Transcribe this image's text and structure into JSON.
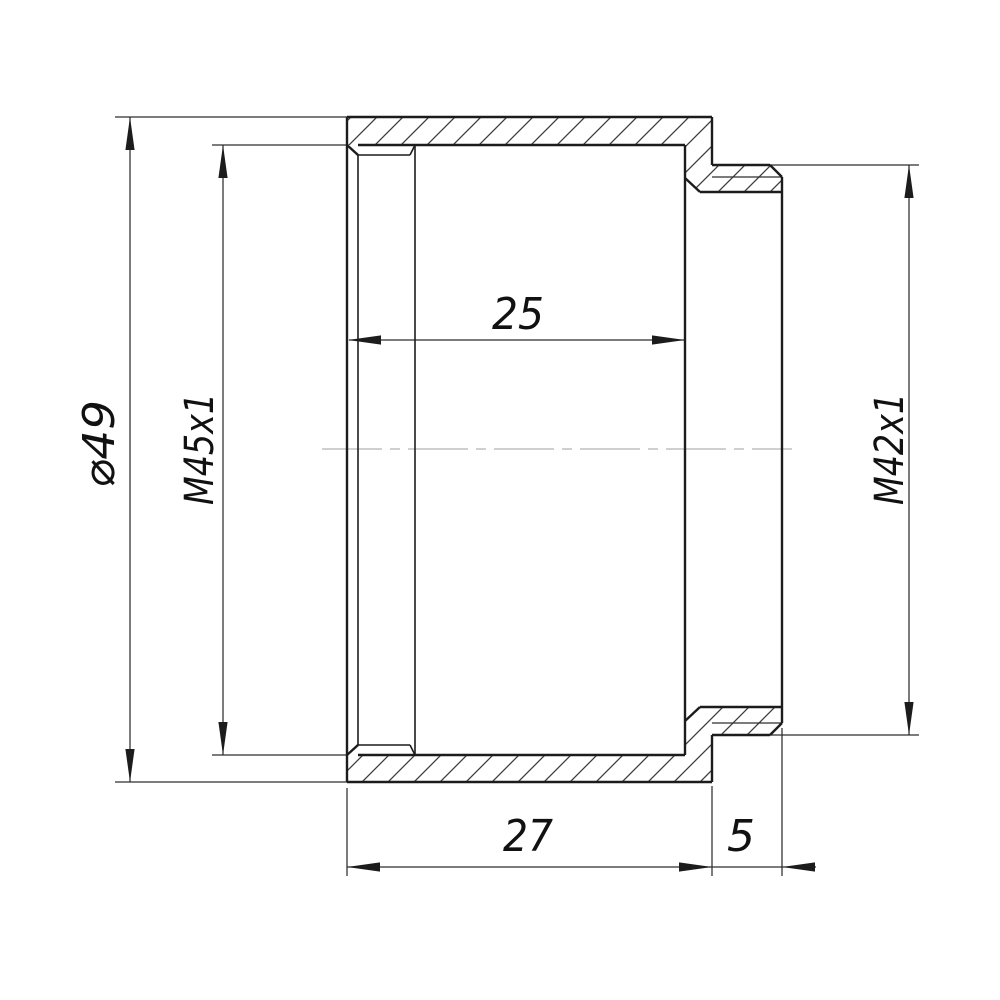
{
  "drawing": {
    "description": "cross-section drawing of a threaded step adapter ring",
    "dimension_values": {
      "outer_diameter": "⌀49",
      "left_internal_thread": "M45x1",
      "bore_depth": "25",
      "right_external_thread": "M42x1",
      "body_length": "27",
      "barrel_length": "5"
    },
    "colors": {
      "background": "#ffffff",
      "outline": "#1c1c1c",
      "thin_line": "#2e2e2e",
      "hatch": "#3c3c3c",
      "centerline": "#b3b3b3",
      "text": "#111111"
    },
    "labels": [
      {
        "id": "dim-label-outer-diameter",
        "text": "⌀49",
        "x": 114,
        "y": 444,
        "rotate": -90,
        "size": 44,
        "length": 88
      },
      {
        "id": "dim-label-left-thread",
        "text": "M45x1",
        "x": 213,
        "y": 449,
        "rotate": -90,
        "size": 40,
        "length": 112
      },
      {
        "id": "dim-label-bore-depth",
        "text": "25",
        "x": 518,
        "y": 329,
        "rotate": 0,
        "size": 44,
        "length": 52
      },
      {
        "id": "dim-label-right-thread",
        "text": "M42x1",
        "x": 903,
        "y": 449,
        "rotate": -90,
        "size": 40,
        "length": 112
      },
      {
        "id": "dim-label-body-length",
        "text": "27",
        "x": 528,
        "y": 851,
        "rotate": 0,
        "size": 44,
        "length": 50
      },
      {
        "id": "dim-label-barrel-length",
        "text": "5",
        "x": 741,
        "y": 851,
        "rotate": 0,
        "size": 44,
        "length": 28
      }
    ],
    "hatch_regions": [
      {
        "id": "section-upper-wall",
        "path": "M347,117 L712,117 L712,165 L770,165 L782,177 L782,192 L700,192 L685,178 L685,145 L347,145 Z"
      },
      {
        "id": "section-lower-wall",
        "path": "M347,782 L712,782 L712,735 L770,735 L782,723 L782,707 L700,707 L685,721 L685,755 L347,755 Z"
      }
    ],
    "outline_lines": [
      [
        347,
        117,
        712,
        117
      ],
      [
        347,
        782,
        712,
        782
      ],
      [
        347,
        117,
        347,
        782
      ],
      [
        712,
        117,
        712,
        165
      ],
      [
        712,
        735,
        712,
        782
      ],
      [
        712,
        165,
        770,
        165
      ],
      [
        770,
        165,
        782,
        177
      ],
      [
        712,
        735,
        770,
        735
      ],
      [
        770,
        735,
        782,
        723
      ],
      [
        782,
        177,
        782,
        723
      ],
      [
        685,
        145,
        685,
        755
      ],
      [
        358,
        145,
        685,
        145
      ],
      [
        358,
        755,
        685,
        755
      ],
      [
        347,
        145,
        358,
        155
      ],
      [
        347,
        755,
        358,
        745
      ],
      [
        700,
        192,
        782,
        192
      ],
      [
        700,
        707,
        782,
        707
      ],
      [
        685,
        178,
        700,
        192
      ],
      [
        685,
        721,
        700,
        707
      ]
    ],
    "medium_lines": [
      [
        358,
        155,
        358,
        745
      ],
      [
        415,
        145,
        415,
        755
      ],
      [
        358,
        155,
        410,
        155
      ],
      [
        358,
        745,
        410,
        745
      ],
      [
        410,
        155,
        415,
        145
      ],
      [
        410,
        745,
        415,
        755
      ]
    ],
    "thin_lines": [
      [
        712,
        177,
        782,
        177
      ],
      [
        712,
        723,
        782,
        723
      ],
      [
        115,
        117,
        348,
        117
      ],
      [
        115,
        782,
        348,
        782
      ],
      [
        212,
        145,
        348,
        145
      ],
      [
        212,
        755,
        348,
        755
      ],
      [
        770,
        165,
        919,
        165
      ],
      [
        770,
        735,
        919,
        735
      ],
      [
        347,
        788,
        347,
        876
      ],
      [
        712,
        786,
        712,
        876
      ],
      [
        782,
        728,
        782,
        876
      ],
      [
        130,
        117,
        130,
        782
      ],
      [
        223,
        145,
        223,
        755
      ],
      [
        349,
        340,
        685,
        340
      ],
      [
        909,
        165,
        909,
        735
      ],
      [
        347,
        867,
        816,
        867
      ]
    ],
    "centerline": {
      "x1": 322,
      "y": 449,
      "x2": 792,
      "dash": "60 8 10 8"
    },
    "arrows": [
      {
        "id": "arrow-d49-top",
        "dir": "up",
        "x": 130,
        "y": 117
      },
      {
        "id": "arrow-d49-bottom",
        "dir": "down",
        "x": 130,
        "y": 782
      },
      {
        "id": "arrow-m45-top",
        "dir": "up",
        "x": 223,
        "y": 145
      },
      {
        "id": "arrow-m45-bottom",
        "dir": "down",
        "x": 223,
        "y": 755
      },
      {
        "id": "arrow-25-left",
        "dir": "left",
        "x": 348,
        "y": 340
      },
      {
        "id": "arrow-25-right",
        "dir": "right",
        "x": 685,
        "y": 340
      },
      {
        "id": "arrow-m42-top",
        "dir": "up",
        "x": 909,
        "y": 165
      },
      {
        "id": "arrow-m42-bottom",
        "dir": "down",
        "x": 909,
        "y": 735
      },
      {
        "id": "arrow-27-left",
        "dir": "left",
        "x": 347,
        "y": 867
      },
      {
        "id": "arrow-27-right",
        "dir": "right",
        "x": 712,
        "y": 867
      },
      {
        "id": "arrow-5-right-out",
        "dir": "left",
        "x": 782,
        "y": 867
      }
    ],
    "arrow_geometry": {
      "length": 33,
      "half_width": 4.6
    }
  }
}
